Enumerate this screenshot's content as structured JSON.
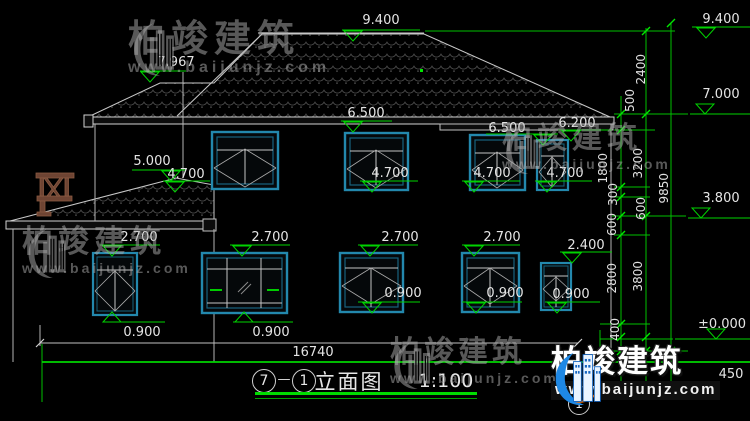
{
  "watermark": {
    "brand": "柏竣建筑",
    "url": "www.baijunjz.com"
  },
  "title": {
    "axis_start": "7",
    "separator": "—",
    "axis_end": "1",
    "name": "立面图",
    "scale": "1:100"
  },
  "grid_bubble": "1",
  "dims": {
    "total_width": "16740",
    "r2400": "2400",
    "r500": "500",
    "r1800": "1800",
    "r3200": "3200",
    "r9850": "9850",
    "r300": "300",
    "r600a": "600",
    "r600b": "600",
    "r2800": "2800",
    "r3800": "3800",
    "r400": "400",
    "r450": "450"
  },
  "levels": {
    "ridge_left": "9.400",
    "ridge_right": "9.400",
    "sub_ridge": "7.967",
    "upper_right": "7.000",
    "eave_a": "6.500",
    "eave_b": "6.500",
    "eave_c": "6.200",
    "wing_top": "5.000",
    "sill2f_1": "4.700",
    "sill2f_2": "4.700",
    "sill2f_3": "4.700",
    "sill2f_4": "4.700",
    "floor2": "3.800",
    "head1f_1": "2.700",
    "head1f_2": "2.700",
    "head1f_3": "2.700",
    "head1f_4": "2.700",
    "head1f_5": "2.400",
    "sill1f_1": "0.900",
    "sill1f_2": "0.900",
    "sill1f_3": "0.900",
    "sill1f_4": "0.900",
    "sill1f_5": "0.900",
    "ground": "±0.000"
  },
  "colors": {
    "dimension_green": "#00d400",
    "window_teal": "#2388ad",
    "line_gray": "#c8c8c8",
    "wood_brown": "#6e4433"
  }
}
